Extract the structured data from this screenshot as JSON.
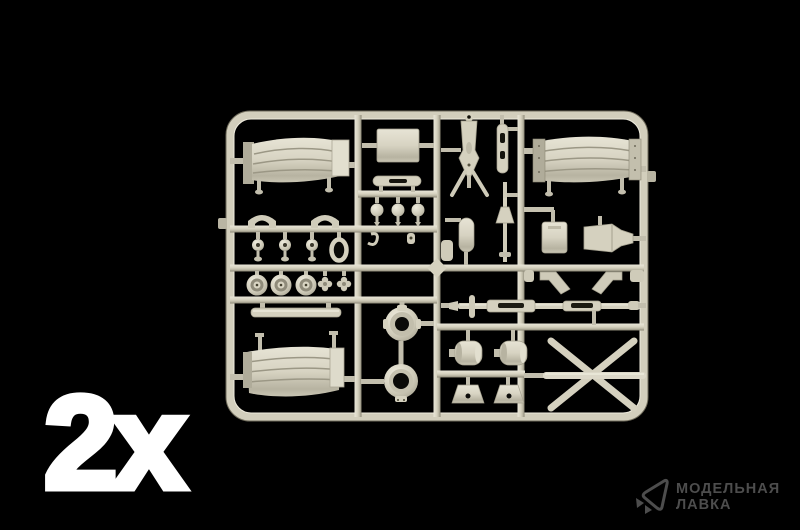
{
  "image": {
    "type": "product-photo",
    "subject": "plastic model kit sprue of beige injection-molded parts on black background",
    "background_color": "#000000"
  },
  "quantity": {
    "label": "2x",
    "color": "#ffffff"
  },
  "sprue": {
    "color": "#d5d1bf",
    "highlight_color": "#e9e6d8",
    "shadow_color": "#84806e",
    "parts": [
      "fender-top-left",
      "fender-top-right",
      "fender-bottom-left",
      "rectangular-plate",
      "tripod-mount",
      "perforated-stick",
      "finial-rod",
      "capsule-part",
      "saddle-bracket-left",
      "saddle-bracket-right",
      "knob-spool-row",
      "ring-handle",
      "wheel-hub-row",
      "clover-nut-pair",
      "flat-bar",
      "slotted-bar",
      "spool-row",
      "hub-ring-upper",
      "hub-ring-lower",
      "v-bracket-left",
      "v-bracket-right",
      "small-plate",
      "funnel-wedge",
      "barrel-axle",
      "cylinder-drum-left",
      "cylinder-drum-right",
      "trapezoid-bracket-left",
      "trapezoid-bracket-right",
      "x-trail-legs"
    ]
  },
  "watermark": {
    "icon": "paper-plane-icon",
    "line1": "МОДЕЛЬНАЯ",
    "line2": "ЛАВКА",
    "color": "#4d4d4d"
  }
}
